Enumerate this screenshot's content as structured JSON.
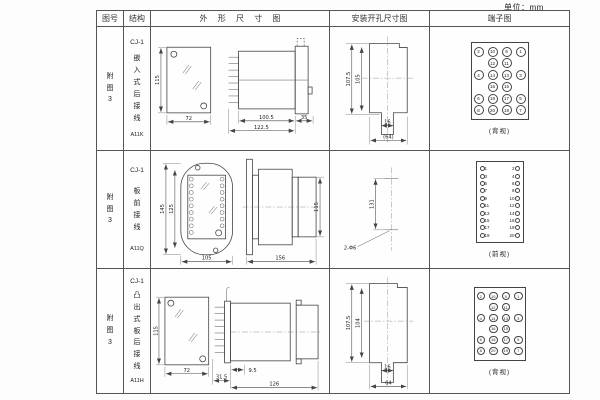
{
  "unit_label": "单位：mm",
  "headers": {
    "fig_no": "图号",
    "structure": "结构",
    "outline": "外 形 尺 寸 图",
    "mounting": "安装开孔尺寸图",
    "terminal": "端子图"
  },
  "rows": [
    {
      "fig_no": "附图3",
      "series": "CJ-1",
      "structure": "嵌入式后接线",
      "model": "A11K",
      "outline": {
        "front_h": "115",
        "front_w": "72",
        "body_l": "100.5",
        "total_l": "122.5",
        "flange": "35"
      },
      "mounting": {
        "outer_h": "107.5",
        "inner_h": "105",
        "notch_w": "16",
        "width": "(64)"
      },
      "terminal_caption": "(背视)"
    },
    {
      "fig_no": "附图3",
      "series": "CJ-1",
      "structure": "板前接线",
      "model": "A11Q",
      "outline": {
        "outer_h": "145",
        "inner_h": "125",
        "front_w": "105",
        "total_l": "156",
        "side_h": "115"
      },
      "mounting": {
        "hole_dist": "131",
        "holes": "2-Φ6"
      },
      "terminal_caption": "(前视)"
    },
    {
      "fig_no": "附图3",
      "series": "CJ-1",
      "structure": "凸出式板后接线",
      "model": "A11H",
      "outline": {
        "front_h": "115",
        "front_w": "72",
        "pin_l": "9.5",
        "base_l": "31.5",
        "total_l": "126"
      },
      "mounting": {
        "outer_h": "107.5",
        "inner_h": "104",
        "notch_w": "16",
        "width": "64"
      },
      "terminal_caption": "(背视)"
    }
  ],
  "terminals": {
    "back_rows": [
      [
        "2",
        "10",
        "9",
        "1"
      ],
      [
        "",
        "12",
        "11",
        ""
      ],
      [
        "4",
        "14",
        "13",
        "3"
      ],
      [
        "",
        "16",
        "15",
        ""
      ],
      [
        "6",
        "18",
        "17",
        "5"
      ],
      [
        "8",
        "20",
        "19",
        "7"
      ]
    ],
    "front_rows": [
      [
        "1",
        "2"
      ],
      [
        "3",
        "4"
      ],
      [
        "5",
        "6"
      ],
      [
        "7",
        "8"
      ],
      [
        "9",
        "10"
      ],
      [
        "11",
        "12"
      ],
      [
        "13",
        "14"
      ],
      [
        "15",
        "16"
      ],
      [
        "17",
        "18"
      ],
      [
        "19",
        "20"
      ]
    ]
  }
}
